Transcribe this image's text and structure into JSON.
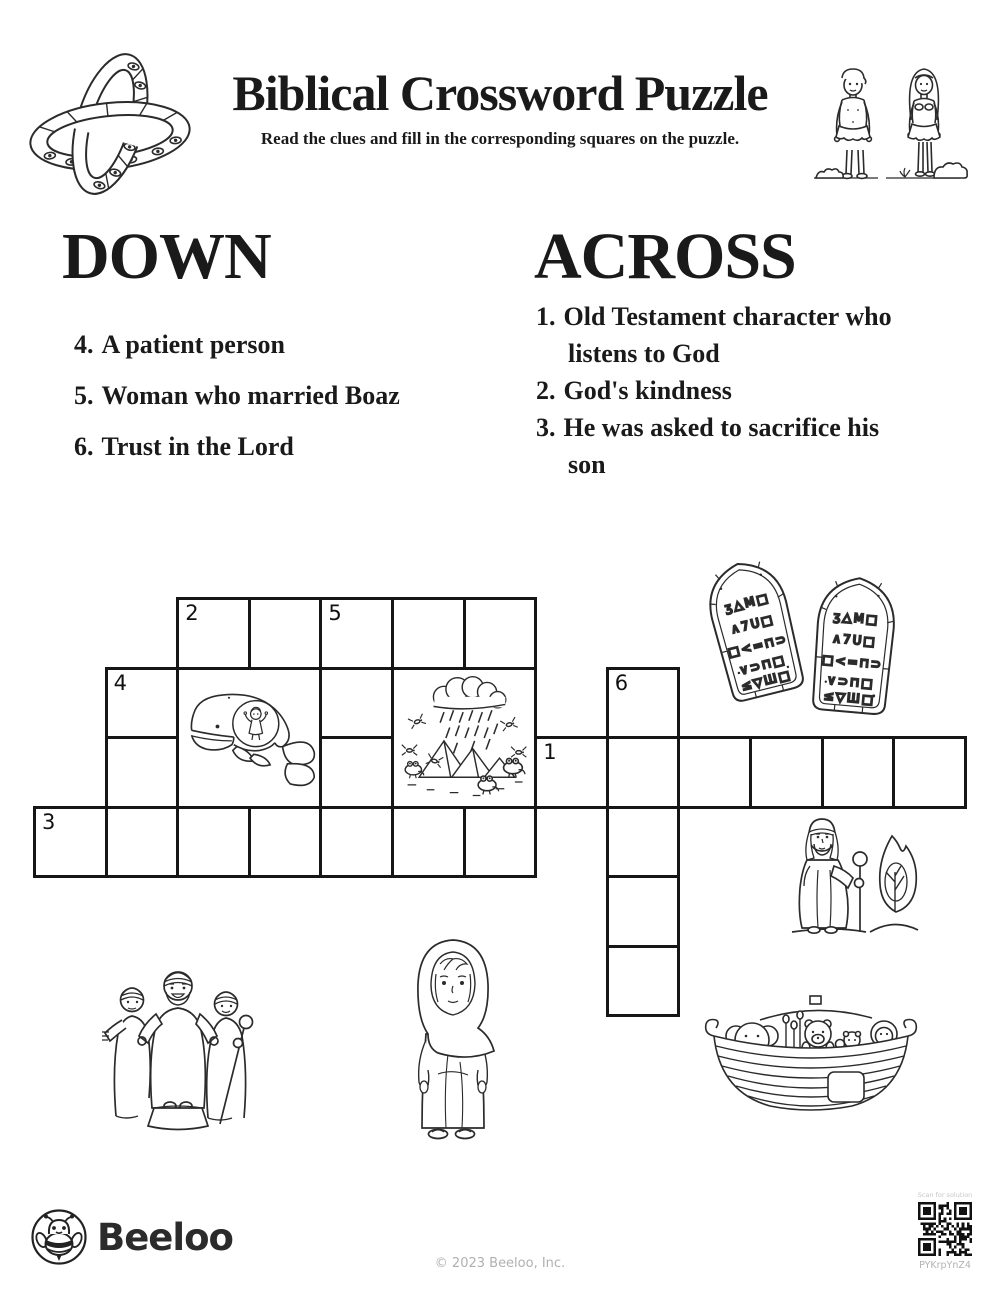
{
  "header": {
    "title": "Biblical Crossword Puzzle",
    "subtitle": "Read the clues and fill in the corresponding squares on the puzzle."
  },
  "clues": {
    "down": {
      "heading": "DOWN",
      "items": [
        {
          "num": "4.",
          "text": "A patient person"
        },
        {
          "num": "5.",
          "text": "Woman who married Boaz"
        },
        {
          "num": "6.",
          "text": "Trust in the Lord"
        }
      ]
    },
    "across": {
      "heading": "ACROSS",
      "items": [
        {
          "num": "1.",
          "text": "Old Testament character who listens to God"
        },
        {
          "num": "2.",
          "text": "God's kindness"
        },
        {
          "num": "3.",
          "text": "He was asked to sacrifice his son"
        }
      ]
    }
  },
  "grid": {
    "origin_x": 33,
    "origin_y": 597,
    "cell_w": 71.6,
    "cell_h": 69.5,
    "border": 3,
    "cells": [
      {
        "r": 0,
        "c": 2,
        "n": "2"
      },
      {
        "r": 0,
        "c": 3
      },
      {
        "r": 0,
        "c": 4,
        "n": "5"
      },
      {
        "r": 0,
        "c": 5
      },
      {
        "r": 0,
        "c": 6
      },
      {
        "r": 1,
        "c": 1,
        "n": "4"
      },
      {
        "r": 1,
        "c": 4
      },
      {
        "r": 1,
        "c": 8,
        "n": "6"
      },
      {
        "r": 2,
        "c": 1
      },
      {
        "r": 2,
        "c": 4
      },
      {
        "r": 2,
        "c": 7,
        "n": "1"
      },
      {
        "r": 2,
        "c": 8
      },
      {
        "r": 2,
        "c": 9
      },
      {
        "r": 2,
        "c": 10
      },
      {
        "r": 2,
        "c": 11
      },
      {
        "r": 2,
        "c": 12
      },
      {
        "r": 3,
        "c": 0,
        "n": "3"
      },
      {
        "r": 3,
        "c": 1
      },
      {
        "r": 3,
        "c": 2
      },
      {
        "r": 3,
        "c": 3
      },
      {
        "r": 3,
        "c": 4
      },
      {
        "r": 3,
        "c": 5
      },
      {
        "r": 3,
        "c": 6
      },
      {
        "r": 3,
        "c": 8
      },
      {
        "r": 4,
        "c": 8
      },
      {
        "r": 5,
        "c": 8
      }
    ],
    "image_blocks": [
      {
        "r": 1,
        "c": 2,
        "rows": 2,
        "cols": 2,
        "icon": "jonah-whale"
      },
      {
        "r": 1,
        "c": 5,
        "rows": 2,
        "cols": 2,
        "icon": "plagues-of-egypt"
      }
    ]
  },
  "tablets": {
    "rows": [
      "ʒ△M□",
      "∧7U□",
      "□<=⊓⊃",
      "∨⊃⊓□",
      "≤▽Ш□"
    ]
  },
  "illustrations": [
    "ophanim-rings-cross",
    "adam-and-eve",
    "ten-commandments-tablets",
    "jonah-whale",
    "plagues-of-egypt",
    "moses-burning-bush",
    "joseph-and-brothers",
    "ruth-woman",
    "noahs-ark",
    "beeloo-bee-logo",
    "qr-code"
  ],
  "footer": {
    "brand": "Beeloo",
    "copyright": "© 2023 Beeloo, Inc.",
    "qr_label": "Scan for solution",
    "qr_code": "PYKrpYnZ4"
  }
}
